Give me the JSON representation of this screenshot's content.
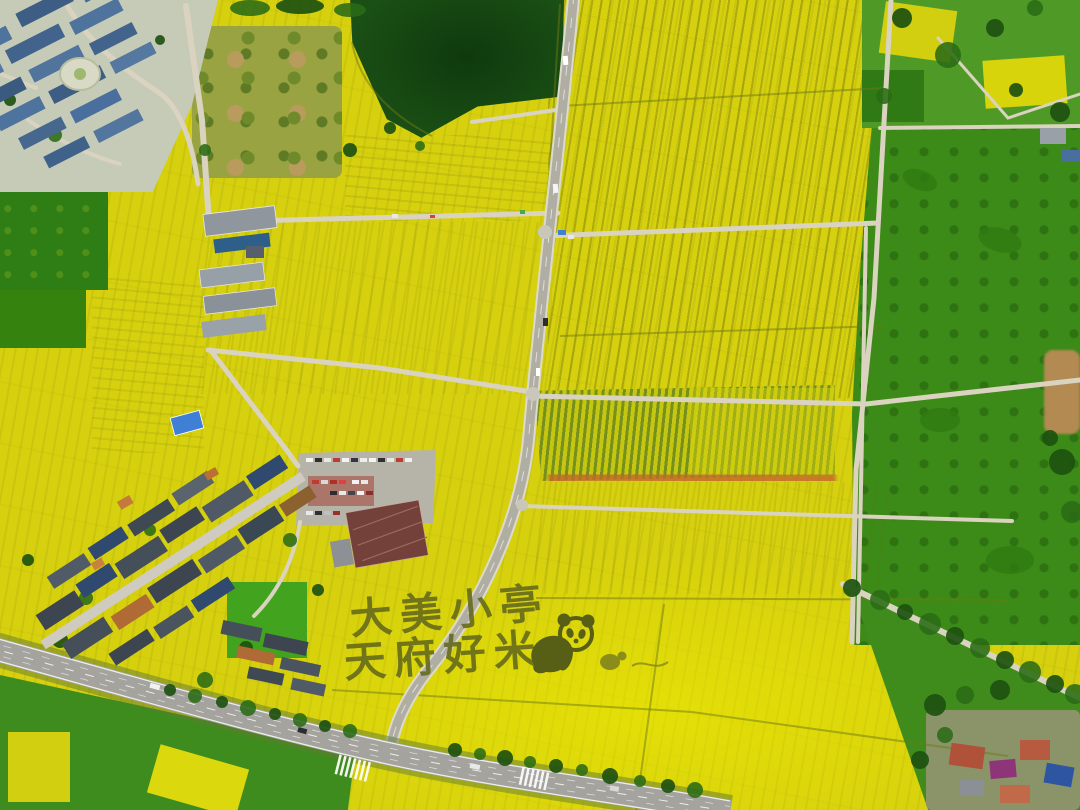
{
  "field_art": {
    "line1": "大美小亭",
    "line2": "天府好米",
    "panda_name": "panda-crop-art",
    "creature_name": "small-creature-crop-art"
  },
  "palette": {
    "rapeseed_yellow": "#d6d00e",
    "rapeseed_bright": "#e8e300",
    "field_green": "#3c8a17",
    "dark_pond_green": "#1a4f15",
    "path_tan": "#d9d3bf",
    "road_gray": "#b0aea2",
    "highway_gray": "#a4a39e",
    "tree_green": "#1d5110",
    "art_dark": "#63681b",
    "roof_blue": "#4a6f9e",
    "roof_slate": "#3f4650",
    "roof_orange": "#b06a35",
    "roof_red": "#b0513a",
    "roof_purple": "#8e3579",
    "roof_brown": "#73413a",
    "stripe_olive": "#76901e",
    "orange_row": "#c2682a",
    "tan_patch": "#b28a52"
  }
}
